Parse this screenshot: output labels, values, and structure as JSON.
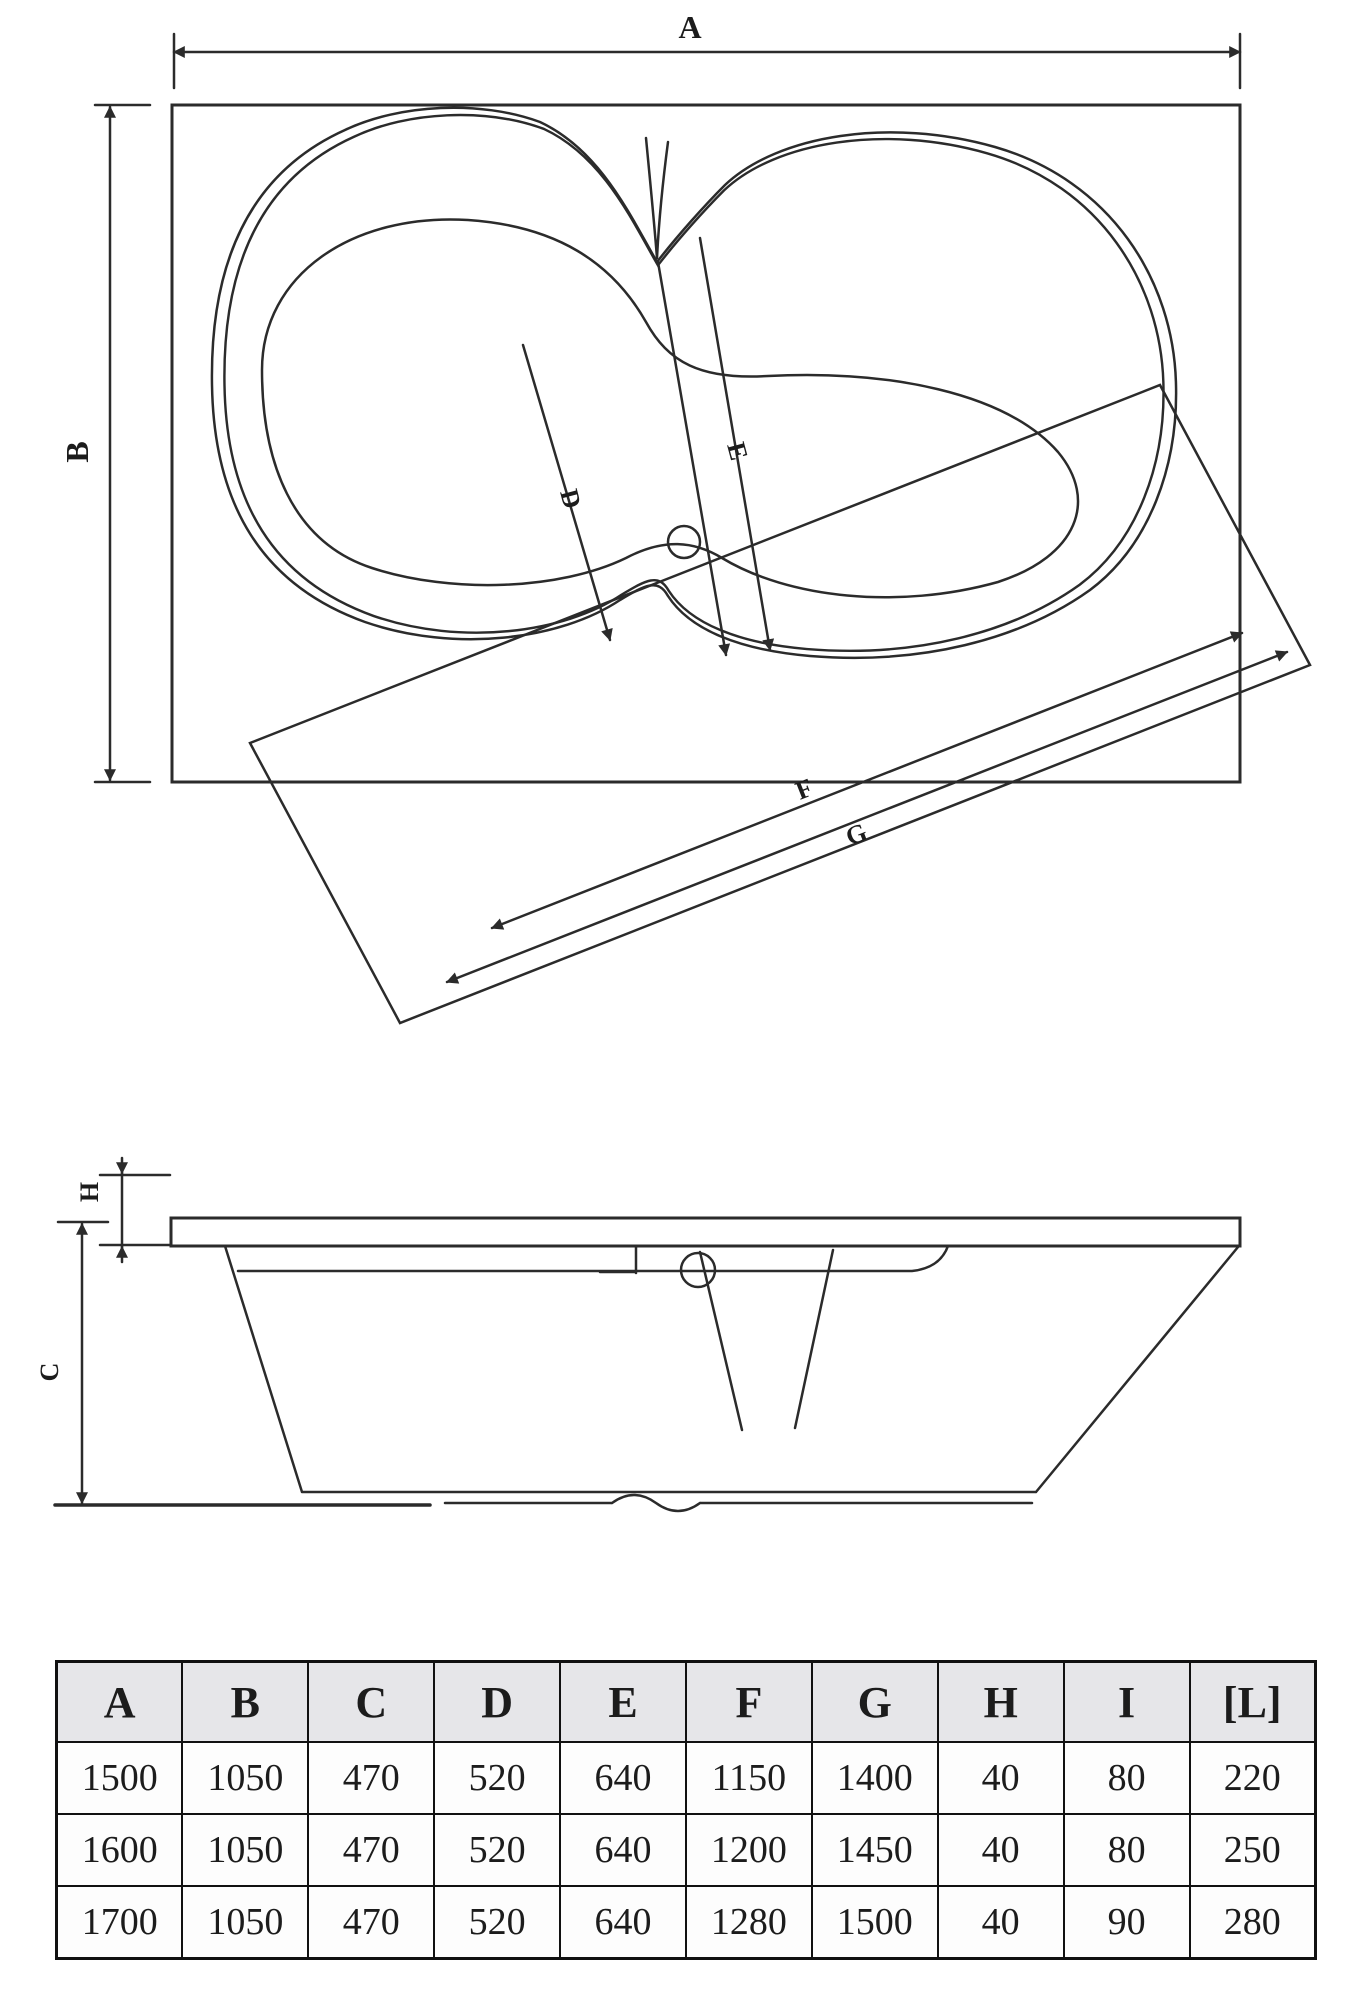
{
  "drawing": {
    "plan": {
      "label_a": "A",
      "label_b": "B",
      "label_d": "D",
      "label_e": "E",
      "label_f": "F",
      "label_g": "G"
    },
    "side": {
      "label_h": "H",
      "label_c": "C"
    }
  },
  "table": {
    "headers": [
      "A",
      "B",
      "C",
      "D",
      "E",
      "F",
      "G",
      "H",
      "I",
      "[L]"
    ],
    "rows": [
      [
        "1500",
        "1050",
        "470",
        "520",
        "640",
        "1150",
        "1400",
        "40",
        "80",
        "220"
      ],
      [
        "1600",
        "1050",
        "470",
        "520",
        "640",
        "1200",
        "1450",
        "40",
        "80",
        "250"
      ],
      [
        "1700",
        "1050",
        "470",
        "520",
        "640",
        "1280",
        "1500",
        "40",
        "90",
        "280"
      ]
    ]
  },
  "colors": {
    "line": "#2b2b2b",
    "table_border": "#111111",
    "header_background": "#e6e6e9",
    "text": "#1c1c1c",
    "background": "#ffffff"
  }
}
